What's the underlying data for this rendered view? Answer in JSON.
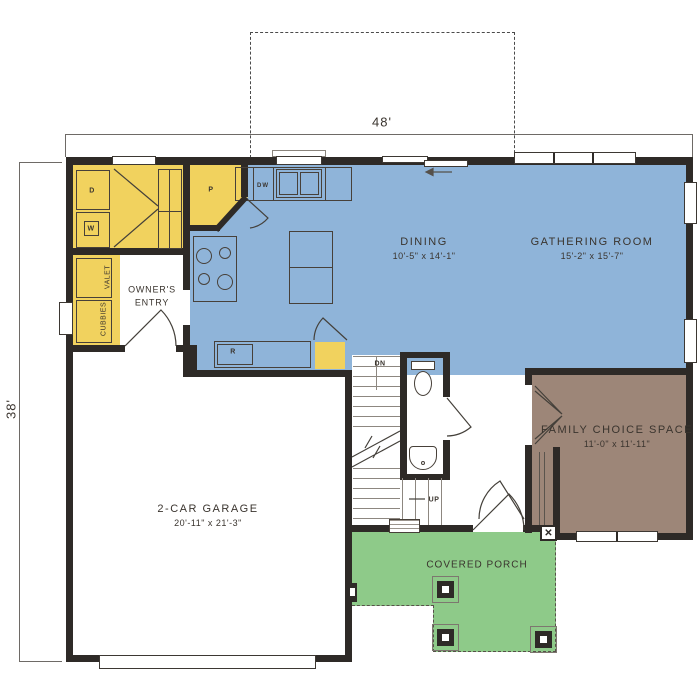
{
  "plan": {
    "dimension_width": "48'",
    "dimension_height": "38'",
    "rooms": {
      "dining": {
        "name": "DINING",
        "size": "10'-5\" x 14'-1\""
      },
      "gathering": {
        "name": "GATHERING ROOM",
        "size": "15'-2\" x 15'-7\""
      },
      "family": {
        "name": "FAMILY CHOICE SPACE",
        "size": "11'-0\" x 11'-11\""
      },
      "garage": {
        "name": "2-CAR GARAGE",
        "size": "20'-11\" x 21'-3\""
      },
      "porch": {
        "name": "COVERED PORCH"
      },
      "owners_entry": {
        "name": "OWNER'S ENTRY"
      }
    },
    "labels": {
      "valet": "VALET",
      "cubbies": "CUBBIES",
      "dryer": "D",
      "washer": "W",
      "pantry": "P",
      "dishwasher": "DW",
      "refrigerator": "R",
      "stairs_down": "DN",
      "stairs_up": "UP",
      "crawl_access": "✕"
    },
    "colors": {
      "living_area": "#8fb4d9",
      "storage": "#f1d25e",
      "porch_floor": "#8eca89",
      "family_space": "#9d8678",
      "walls": "#2e2a27"
    }
  }
}
